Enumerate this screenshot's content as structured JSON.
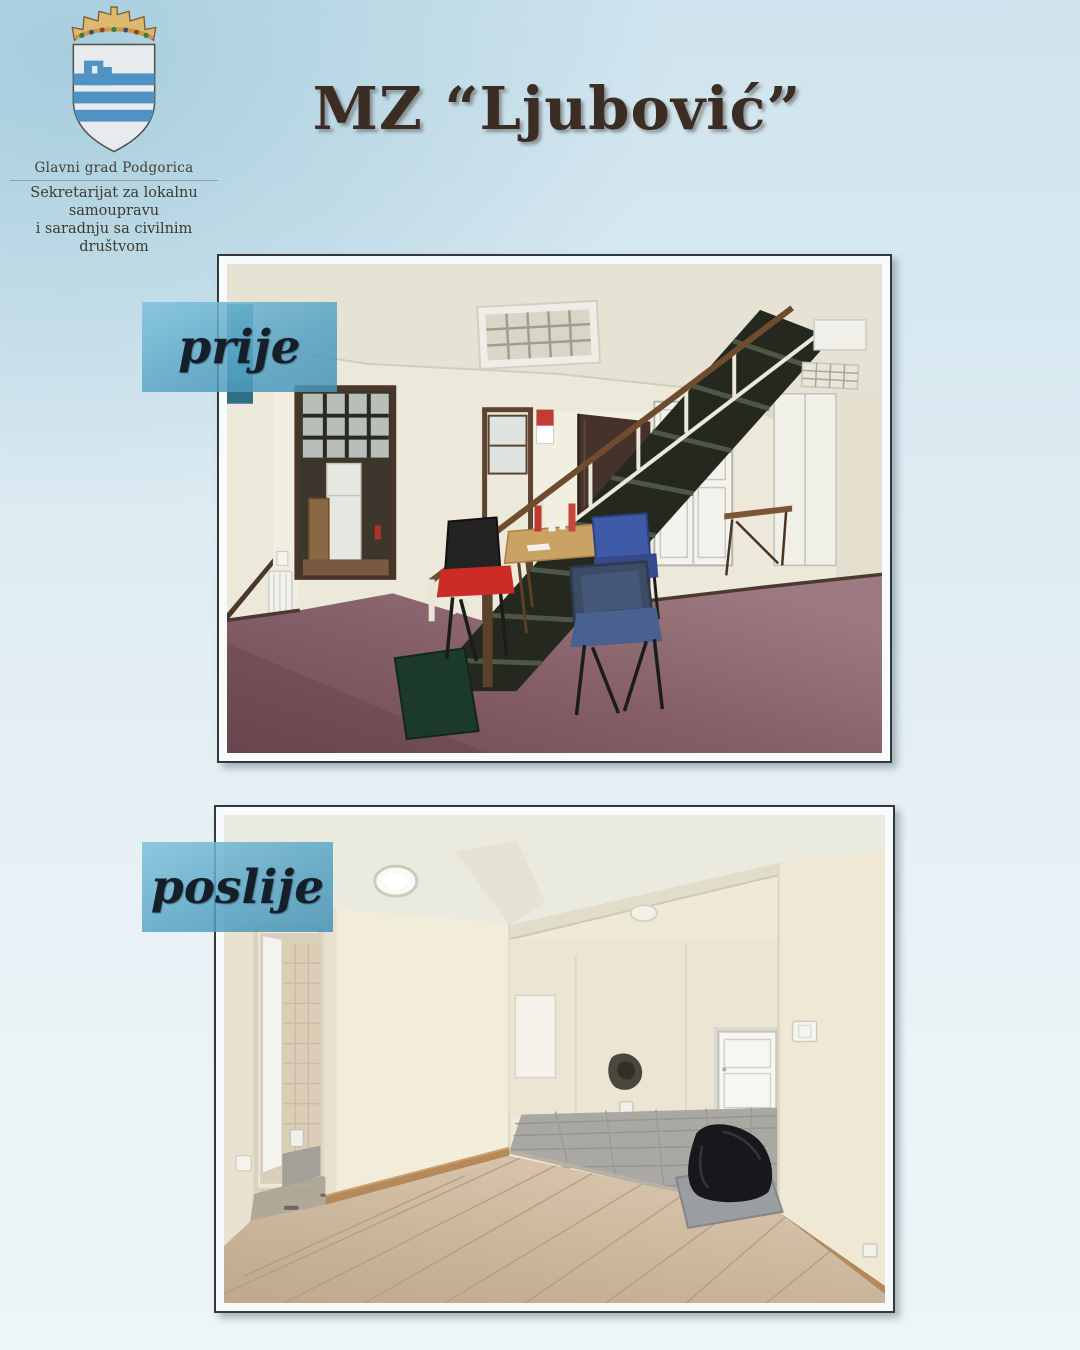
{
  "logo": {
    "org": "Glavni grad Podgorica",
    "dept_line1": "Sekretarijat za lokalnu samoupravu",
    "dept_line2": "i saradnju sa civilnim društvom",
    "emblem_name": "podgorica-coat-of-arms",
    "emblem_colors": {
      "crown": "#dcb96e",
      "shield": "#e7ebed",
      "charge_blue": "#4f93c4"
    }
  },
  "title": {
    "text": "MZ “Ljubović”",
    "color": "#3b2d24"
  },
  "photos": {
    "before": {
      "label": "prije",
      "alt": "Room before renovation: burgundy carpet, dark staircase, small table with red and blue chairs"
    },
    "after": {
      "label": "poslije",
      "alt": "Room after renovation: fresh cream walls, new laminate flooring, tiled area and white door"
    }
  },
  "label_style": {
    "background": "#58a4c6",
    "text_color": "#141f2a"
  }
}
